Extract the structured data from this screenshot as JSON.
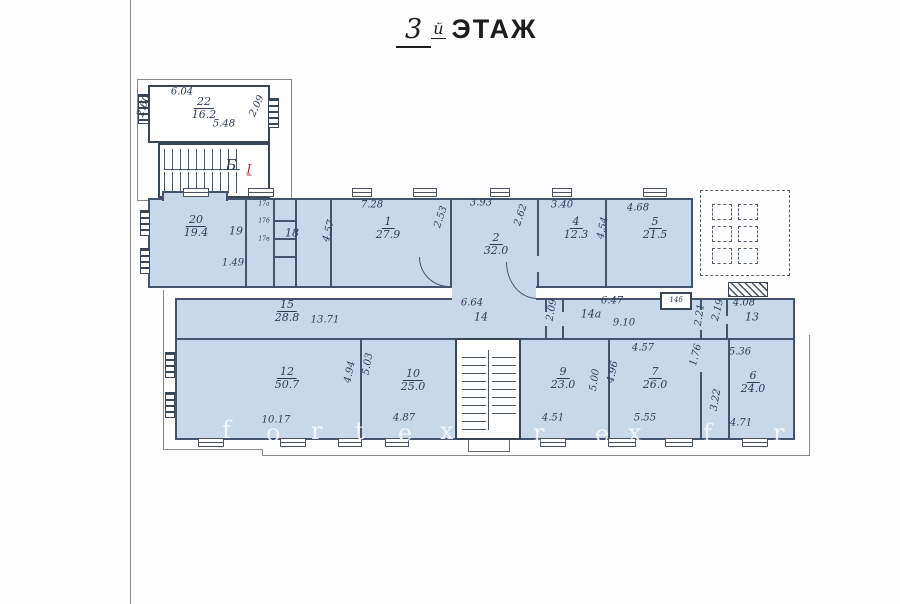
{
  "title": {
    "number": "3",
    "suffix": "й",
    "word": "ЭТАЖ"
  },
  "colors": {
    "room_fill": "#c8d8eb",
    "wall_blue": "#42546e",
    "wall_dark": "#3a4654",
    "dim_text": "#2c3c55",
    "red_mark": "#c03030",
    "watermark": "#fafcff",
    "paper": "#fdfdfd"
  },
  "room_labels": [
    {
      "name": "room-22-label",
      "num": "22",
      "den": "16.2",
      "x": 204,
      "y": 96
    },
    {
      "name": "room-20-label",
      "num": "20",
      "den": "19.4",
      "x": 196,
      "y": 214
    },
    {
      "name": "room-1-label",
      "num": "1",
      "den": "27.9",
      "x": 388,
      "y": 216
    },
    {
      "name": "room-2-label",
      "num": "2",
      "den": "32.0",
      "x": 496,
      "y": 232
    },
    {
      "name": "room-4-label",
      "num": "4",
      "den": "12.3",
      "x": 576,
      "y": 216
    },
    {
      "name": "room-5-label",
      "num": "5",
      "den": "21.5",
      "x": 655,
      "y": 216
    },
    {
      "name": "room-15-label",
      "num": "15",
      "den": "28.8",
      "x": 287,
      "y": 299
    },
    {
      "name": "room-12-label",
      "num": "12",
      "den": "50.7",
      "x": 287,
      "y": 366
    },
    {
      "name": "room-10-label",
      "num": "10",
      "den": "25.0",
      "x": 413,
      "y": 368
    },
    {
      "name": "room-9-label",
      "num": "9",
      "den": "23.0",
      "x": 563,
      "y": 366
    },
    {
      "name": "room-7-label",
      "num": "7",
      "den": "26.0",
      "x": 655,
      "y": 366
    },
    {
      "name": "room-6-label",
      "num": "6",
      "den": "24.0",
      "x": 753,
      "y": 370
    }
  ],
  "dim_labels": [
    {
      "name": "annex-dim-top",
      "text": "6.04",
      "x": 182,
      "y": 92
    },
    {
      "name": "annex-dim-bottom",
      "text": "5.48",
      "x": 224,
      "y": 124
    },
    {
      "name": "annex-dim-left",
      "text": "2.60",
      "x": 144,
      "y": 106,
      "rot": -72
    },
    {
      "name": "annex-dim-right",
      "text": "2.09",
      "x": 257,
      "y": 106,
      "rot": -65
    },
    {
      "name": "stair-label",
      "text": "Б",
      "x": 231,
      "y": 165,
      "size": 15
    },
    {
      "name": "entrance-mark",
      "text": "I",
      "x": 249,
      "y": 170,
      "size": 13,
      "color": "red",
      "underline": true
    },
    {
      "name": "room-19-label",
      "text": "19",
      "x": 236,
      "y": 231,
      "size": 11
    },
    {
      "name": "dim-1-49",
      "text": "1.49",
      "x": 233,
      "y": 263
    },
    {
      "name": "room-18-label",
      "text": "18",
      "x": 292,
      "y": 233,
      "size": 11
    },
    {
      "name": "cell-label-1",
      "text": "17а",
      "x": 264,
      "y": 204,
      "size": 6
    },
    {
      "name": "cell-label-2",
      "text": "17б",
      "x": 264,
      "y": 221,
      "size": 6
    },
    {
      "name": "cell-label-3",
      "text": "17в",
      "x": 264,
      "y": 239,
      "size": 6
    },
    {
      "name": "dim-4-57",
      "text": "4.57",
      "x": 329,
      "y": 231,
      "rot": -75
    },
    {
      "name": "dim-7-28",
      "text": "7.28",
      "x": 372,
      "y": 205
    },
    {
      "name": "dim-2-53",
      "text": "2.53",
      "x": 441,
      "y": 217,
      "rot": -72
    },
    {
      "name": "dim-3-93",
      "text": "3.93",
      "x": 481,
      "y": 203
    },
    {
      "name": "dim-2-62",
      "text": "2.62",
      "x": 521,
      "y": 215,
      "rot": -72
    },
    {
      "name": "dim-3-40",
      "text": "3.40",
      "x": 562,
      "y": 205
    },
    {
      "name": "dim-4-54",
      "text": "4.54",
      "x": 603,
      "y": 228,
      "rot": -78
    },
    {
      "name": "dim-4-68",
      "text": "4.68",
      "x": 638,
      "y": 208
    },
    {
      "name": "dim-13-71",
      "text": "13.71",
      "x": 325,
      "y": 320
    },
    {
      "name": "dim-6-64",
      "text": "6.64",
      "x": 472,
      "y": 303
    },
    {
      "name": "room-14-label",
      "text": "14",
      "x": 481,
      "y": 317,
      "size": 11
    },
    {
      "name": "dim-2-09-corr",
      "text": "2.09",
      "x": 552,
      "y": 310,
      "rot": -80
    },
    {
      "name": "room-14a-label",
      "text": "14а",
      "x": 591,
      "y": 314,
      "size": 11
    },
    {
      "name": "dim-6-47",
      "text": "6.47",
      "x": 612,
      "y": 301
    },
    {
      "name": "dim-9-10",
      "text": "9.10",
      "x": 624,
      "y": 323
    },
    {
      "name": "room-14b-label",
      "text": "14б",
      "x": 676,
      "y": 300,
      "size": 7
    },
    {
      "name": "dim-2-21",
      "text": "2.21",
      "x": 700,
      "y": 315,
      "rot": -82
    },
    {
      "name": "dim-2-19",
      "text": "2.19",
      "x": 718,
      "y": 310,
      "rot": -76
    },
    {
      "name": "dim-4-08",
      "text": "4.08",
      "x": 744,
      "y": 303
    },
    {
      "name": "room-13-label",
      "text": "13",
      "x": 752,
      "y": 317,
      "size": 11
    },
    {
      "name": "dim-4-94",
      "text": "4.94",
      "x": 350,
      "y": 372,
      "rot": -78
    },
    {
      "name": "dim-5-03",
      "text": "5.03",
      "x": 368,
      "y": 364,
      "rot": -80
    },
    {
      "name": "dim-10-17",
      "text": "10.17",
      "x": 276,
      "y": 420
    },
    {
      "name": "dim-4-87",
      "text": "4.87",
      "x": 404,
      "y": 418
    },
    {
      "name": "dim-4-51",
      "text": "4.51",
      "x": 553,
      "y": 418
    },
    {
      "name": "dim-5-00",
      "text": "5.00",
      "x": 595,
      "y": 380,
      "rot": -82
    },
    {
      "name": "dim-4-96",
      "text": "4.96",
      "x": 613,
      "y": 372,
      "rot": -78
    },
    {
      "name": "dim-4-57-b",
      "text": "4.57",
      "x": 643,
      "y": 348
    },
    {
      "name": "dim-5-55",
      "text": "5.55",
      "x": 645,
      "y": 418
    },
    {
      "name": "dim-1-76",
      "text": "1.76",
      "x": 696,
      "y": 355,
      "rot": -76
    },
    {
      "name": "dim-3-22",
      "text": "3.22",
      "x": 716,
      "y": 400,
      "rot": -80
    },
    {
      "name": "dim-5-36",
      "text": "5.36",
      "x": 740,
      "y": 352
    },
    {
      "name": "dim-4-71",
      "text": "4.71",
      "x": 741,
      "y": 423
    }
  ],
  "watermark_letters": [
    {
      "ch": "f",
      "x": 222,
      "y": 416
    },
    {
      "ch": "o",
      "x": 266,
      "y": 419
    },
    {
      "ch": "r",
      "x": 311,
      "y": 417
    },
    {
      "ch": "t",
      "x": 355,
      "y": 417
    },
    {
      "ch": "e",
      "x": 398,
      "y": 419
    },
    {
      "ch": "x",
      "x": 440,
      "y": 417
    },
    {
      "ch": "r",
      "x": 533,
      "y": 419
    },
    {
      "ch": "e",
      "x": 595,
      "y": 420
    },
    {
      "ch": "x",
      "x": 628,
      "y": 419
    },
    {
      "ch": "f",
      "x": 703,
      "y": 419
    },
    {
      "ch": "r",
      "x": 773,
      "y": 419
    }
  ]
}
